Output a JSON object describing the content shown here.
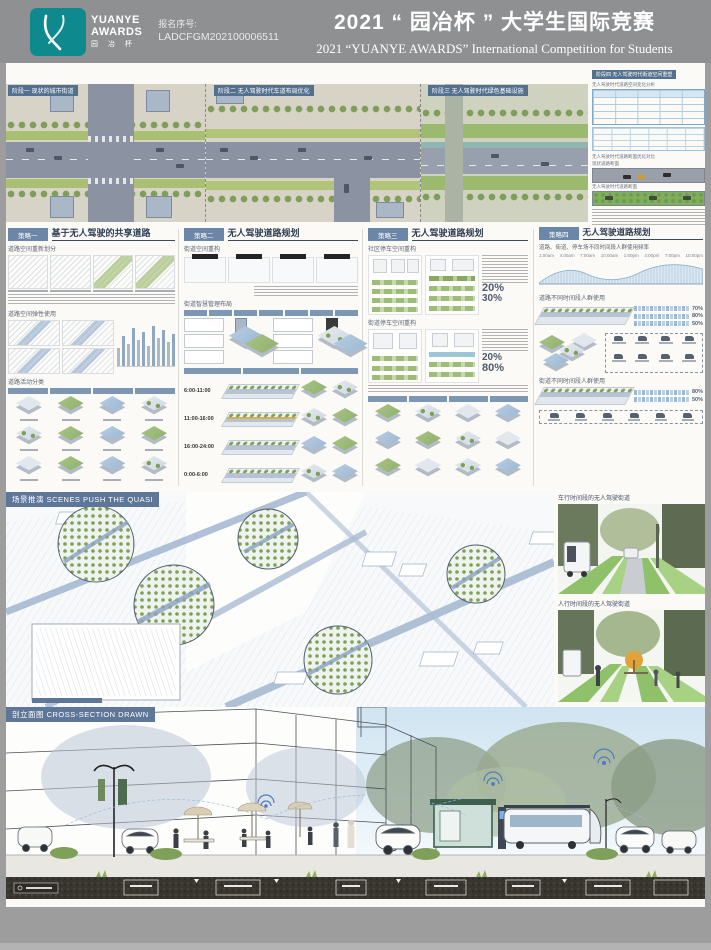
{
  "header": {
    "logo": {
      "line1": "YUANYE",
      "line2": "AWARDS",
      "line3": "园 冶 杯"
    },
    "reg_label": "报名序号:",
    "reg_number": "LADCFGM202100006511",
    "title_cn": "2021 “ 园冶杯 ” 大学生国际竞赛",
    "title_en": "2021 “YUANYE AWARDS” International Competition for  Students"
  },
  "masterplan": {
    "phases": [
      "阶段一  现状的城市街道",
      "阶段二  无人驾驶时代车道布局优化",
      "阶段三  无人驾驶时代绿色基础设施",
      "阶段四  无人驾驶时代街道空间重塑"
    ],
    "side": {
      "table_title": "无人驾驶时代道路空间变化分析",
      "section_title": "无人驾驶时代道路断面优化对比",
      "label_a": "现状道路断面",
      "label_b": "无人驾驶时代道路断面"
    }
  },
  "strategies": [
    {
      "tag": "策略一",
      "title": "基于无人驾驶的共享道路",
      "sec1": "道路空间重新划分",
      "sec2": "道路空间弹性使用",
      "sec3": "道路活动分类"
    },
    {
      "tag": "策略二",
      "title": "无人驾驶道路规划",
      "sec1": "街道空间重构",
      "sec2": "街道智慧管理布局",
      "times": [
        "6:00-11:00",
        "11:00-16:00",
        "16:00-24:00",
        "0:00-6:00"
      ]
    },
    {
      "tag": "策略三",
      "title": "无人驾驶道路规划",
      "sec1": "社区停车空间重构",
      "sec2": "街道停车空间重构",
      "stats": [
        "20%",
        "30%",
        "20%",
        "80%"
      ]
    },
    {
      "tag": "策略四",
      "title": "无人驾驶道路规划",
      "sec1": "道路、街道、停车场不同时间段人群使用频率",
      "sec2": "道路不同时间段人群使用",
      "sec3": "街道不同时间段人群使用",
      "ticks": [
        "1:00am",
        "4:00am",
        "7:00am",
        "10:00am",
        "1:00pm",
        "4:00pm",
        "7:00pm",
        "10:00pm"
      ],
      "percents": [
        "70%",
        "80%",
        "50%"
      ]
    }
  ],
  "scenes": {
    "banner": "场景推演 SCENES PUSH THE QUASI",
    "caption_top": "车行时间段的无人驾驶街道",
    "caption_bottom": "人行时间段的无人驾驶街道"
  },
  "section_view": {
    "banner": "剖立面图 CROSS-SECTION DRAWN"
  },
  "colors": {
    "teal": "#0e8a8e",
    "banner_blue": "#5e7697",
    "header_gray": "#8f9092"
  }
}
